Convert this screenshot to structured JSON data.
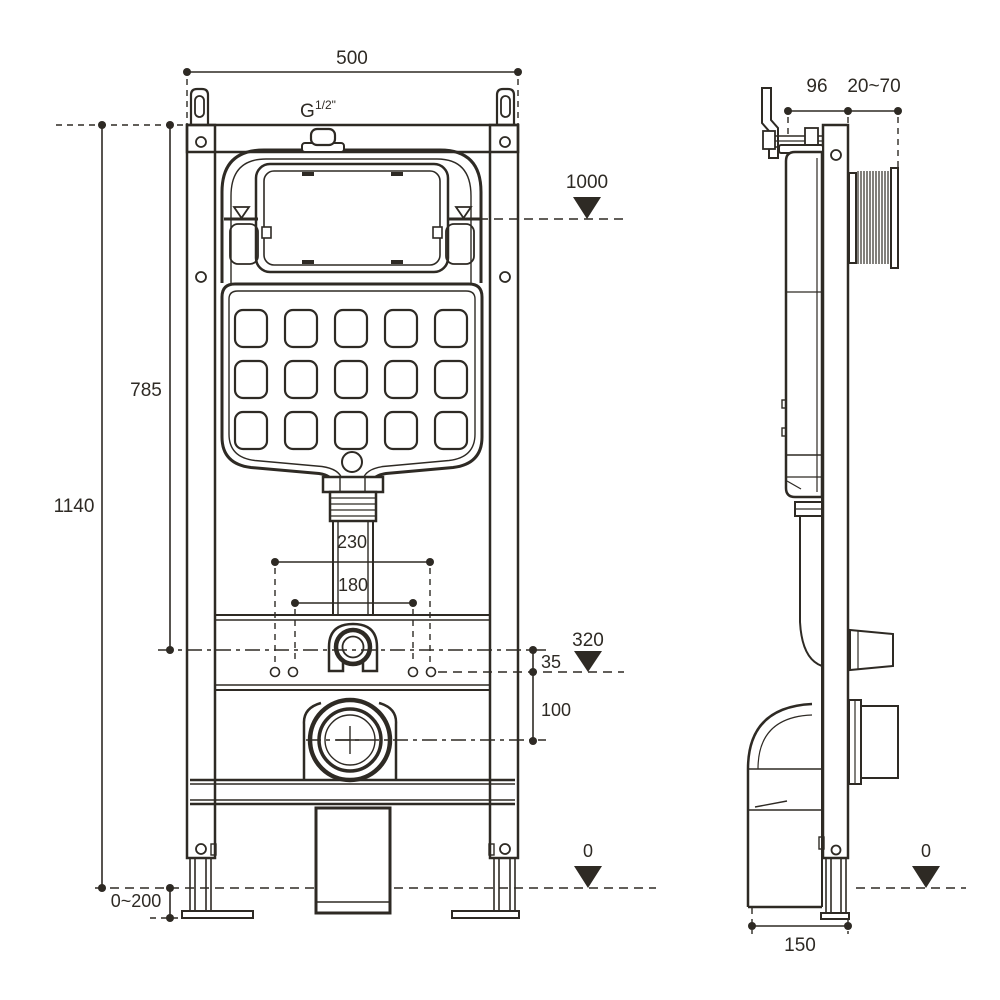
{
  "drawing": {
    "title": "Concealed cistern WC frame installation drawing",
    "line_color": "#2e2a24",
    "background_color": "#ffffff",
    "front_view": {
      "dims": {
        "frame_width": "500",
        "inlet_thread": "G",
        "inlet_thread_size": "1/2\"",
        "water_level": "1000",
        "cistern_height": "785",
        "frame_height": "1140",
        "bend_spacing": "230",
        "bolt_spacing": "180",
        "seat_level": "320",
        "offset_small": "35",
        "outlet_drop": "100",
        "feet_range": "0~200",
        "floor_level": "0"
      }
    },
    "side_view": {
      "dims": {
        "frame_depth": "96",
        "wall_range": "20~70",
        "base_depth": "150",
        "floor_level": "0"
      }
    }
  }
}
